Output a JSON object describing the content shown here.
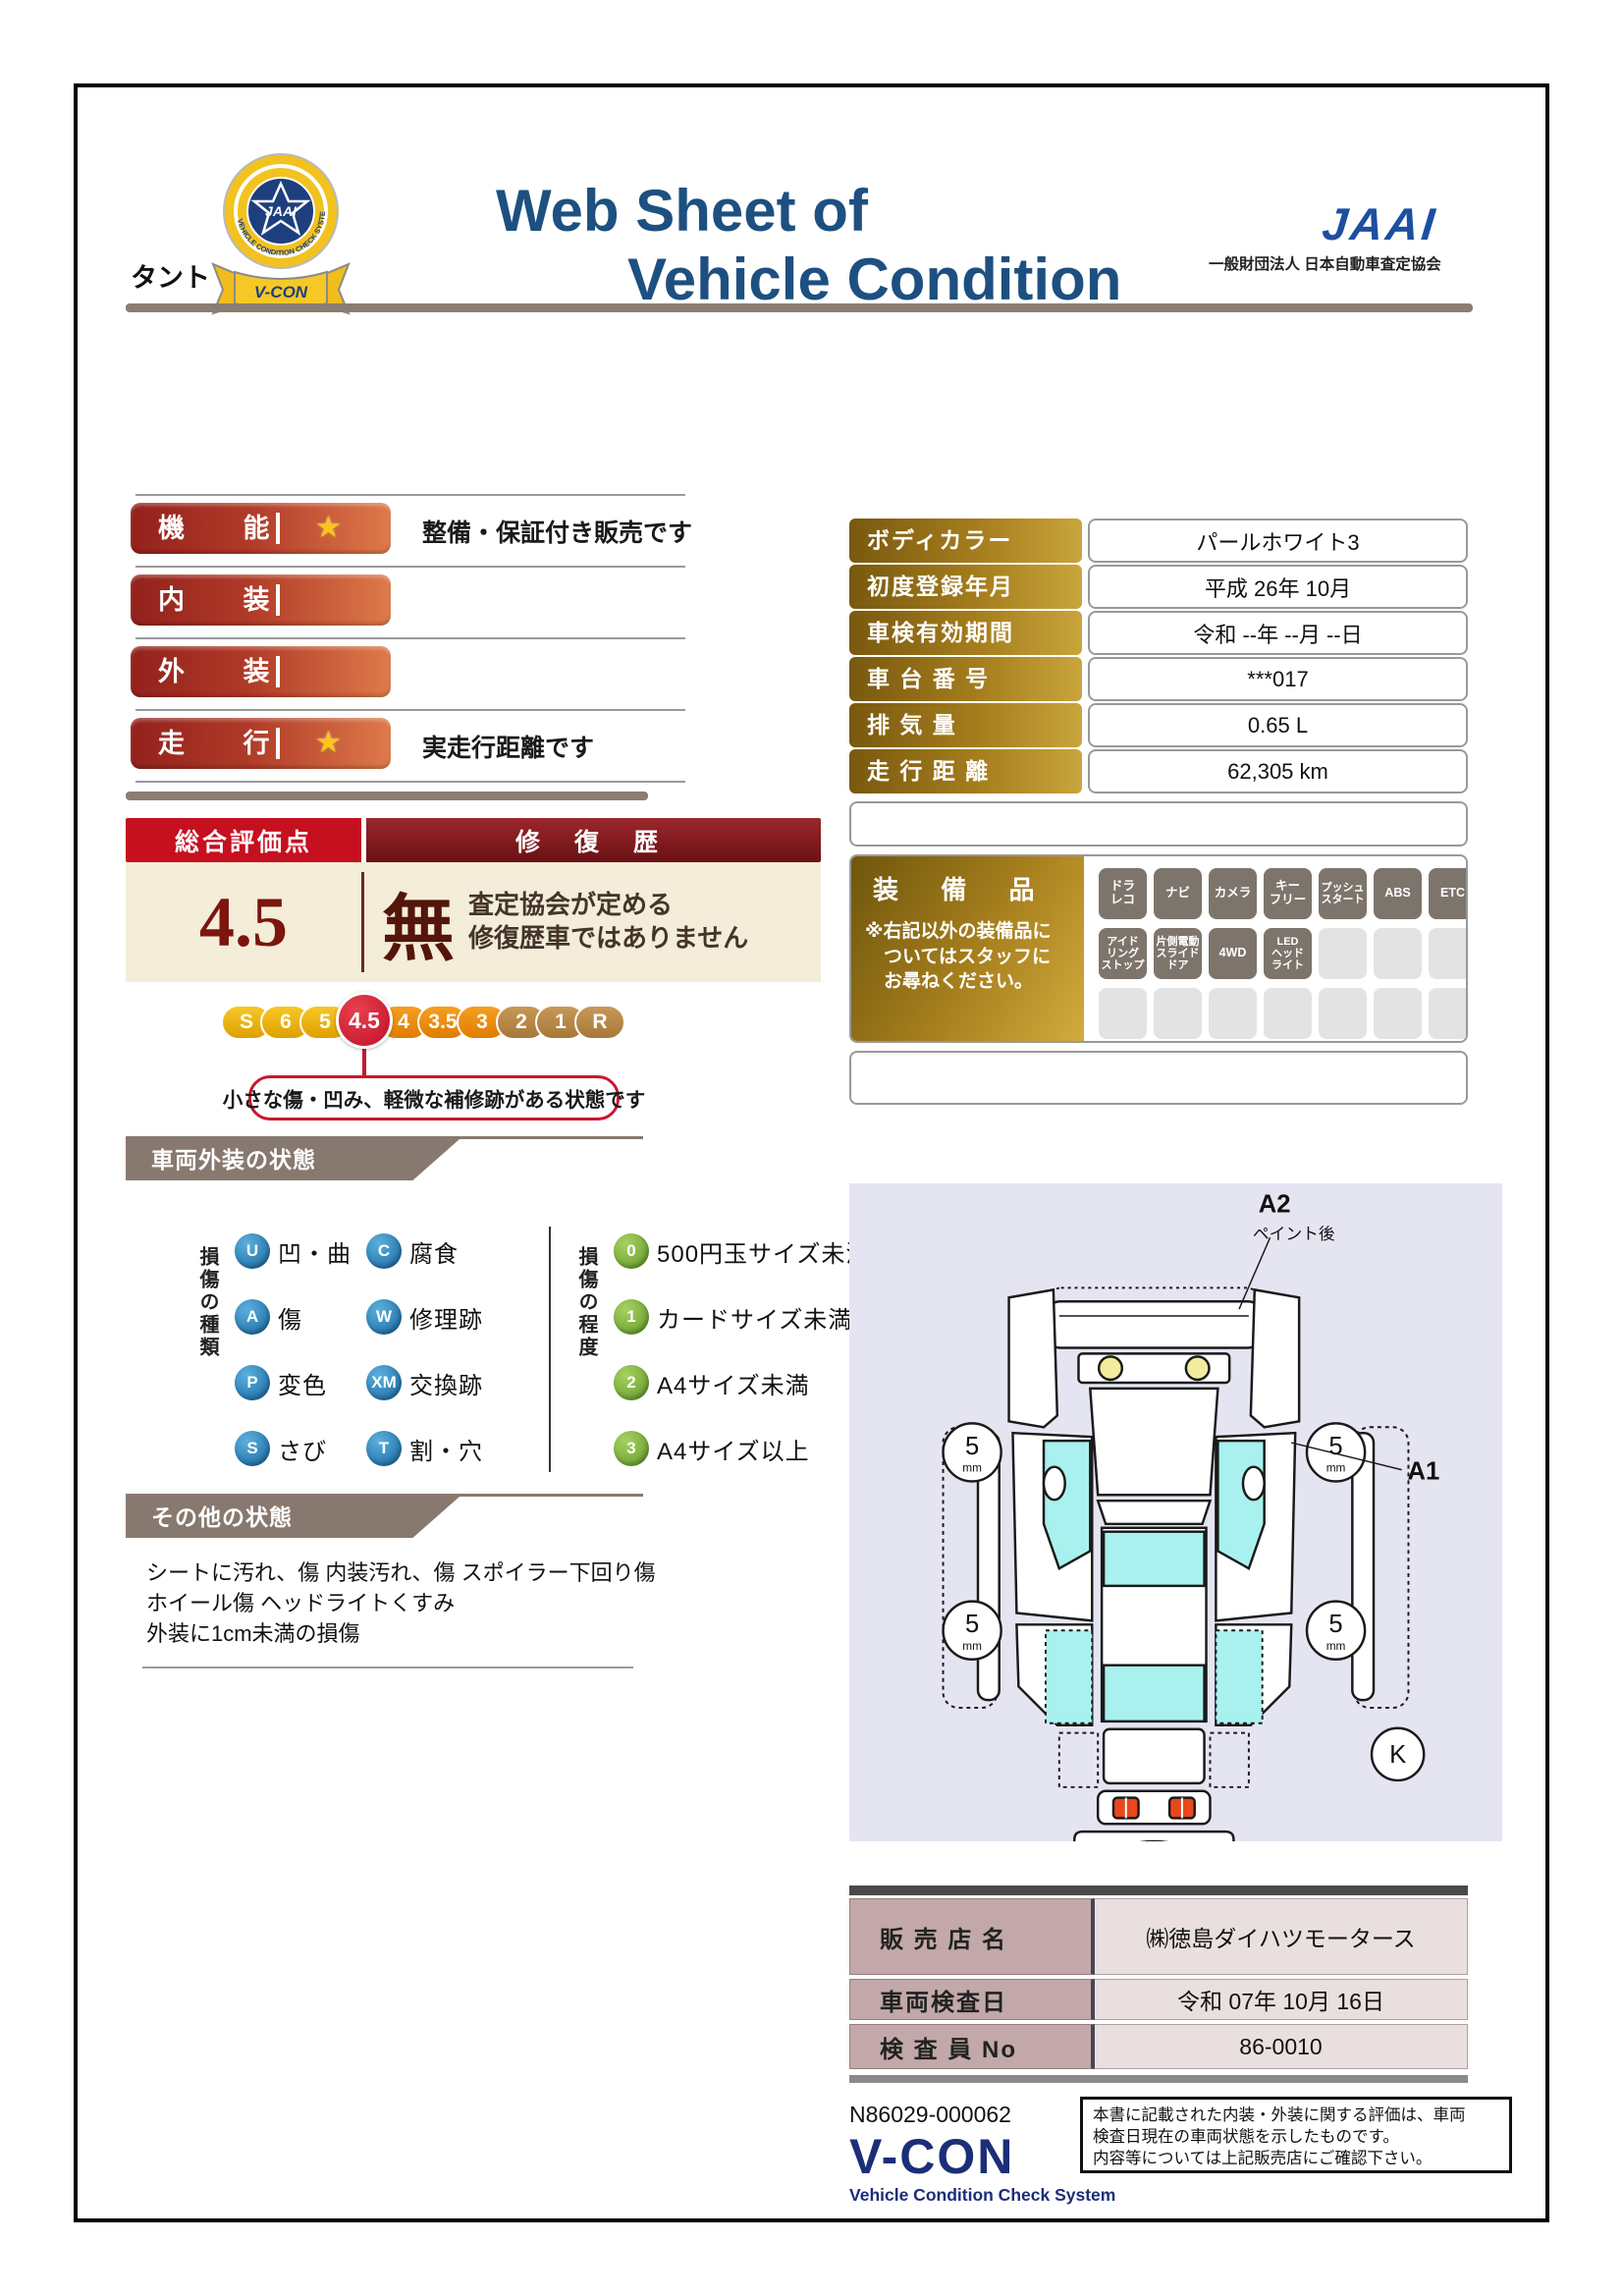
{
  "header": {
    "title_line1": "Web Sheet of",
    "title_line2": "Vehicle Condition",
    "jaai_logo": "JAAI",
    "jaai_org": "一般財団法人 日本自動車査定協会",
    "badge_ribbon": "V-CON",
    "badge_center": "JAAI",
    "badge_ring": "VEHICLE CONDITION CHECK SYSTEM"
  },
  "vehicle_name": "タント",
  "ratings": {
    "rows": [
      {
        "label": "機 能",
        "star": "★",
        "note": "整備・保証付き販売です"
      },
      {
        "label": "内 装",
        "star": "",
        "note": ""
      },
      {
        "label": "外 装",
        "star": "",
        "note": ""
      },
      {
        "label": "走 行",
        "star": "★",
        "note": "実走行距離です"
      }
    ]
  },
  "info": {
    "rows": [
      {
        "label": "ボディカラー",
        "value": "パールホワイト3"
      },
      {
        "label": "初度登録年月",
        "value": "平成 26年 10月"
      },
      {
        "label": "車検有効期間",
        "value": "令和 --年 --月 --日"
      },
      {
        "label": "車 台 番 号",
        "value": "***017"
      },
      {
        "label": "排  気  量",
        "value": "0.65 L"
      },
      {
        "label": "走 行 距 離",
        "value": "62,305 km"
      }
    ]
  },
  "overall": {
    "header_left": "総合評価点",
    "header_right": "修 復 歴",
    "score": "4.5",
    "repair_mark": "無",
    "repair_note": "査定協会が定める\n修復歴車ではありません",
    "scale": [
      "S",
      "6",
      "5",
      "4.5",
      "4",
      "3.5",
      "3",
      "2",
      "1",
      "R"
    ],
    "selected": "4.5",
    "callout": "小さな傷・凹み、軽微な補修跡がある状態です"
  },
  "equipment": {
    "title": "装 備 品",
    "note": "※右記以外の装備品に\n　ついてはスタッフに\n　お尋ねください。",
    "active": [
      "ドラ\nレコ",
      "ナビ",
      "カメラ",
      "キー\nフリー",
      "プッシュ\nスタート",
      "ABS",
      "ETC",
      "アイド\nリング\nストップ",
      "片側電動\nスライド\nドア",
      "4WD",
      "LED\nヘッド\nライト"
    ]
  },
  "exterior": {
    "section_title": "車両外装の状態",
    "kind_label": "損傷の種類",
    "kinds": [
      {
        "code": "U",
        "label": "凹・曲"
      },
      {
        "code": "C",
        "label": "腐食"
      },
      {
        "code": "A",
        "label": "傷"
      },
      {
        "code": "W",
        "label": "修理跡"
      },
      {
        "code": "P",
        "label": "変色"
      },
      {
        "code": "XM",
        "label": "交換跡"
      },
      {
        "code": "S",
        "label": "さび"
      },
      {
        "code": "T",
        "label": "割・穴"
      }
    ],
    "degree_label": "損傷の程度",
    "degrees": [
      {
        "code": "0",
        "label": "500円玉サイズ未満"
      },
      {
        "code": "1",
        "label": "カードサイズ未満"
      },
      {
        "code": "2",
        "label": "A4サイズ未満"
      },
      {
        "code": "3",
        "label": "A4サイズ以上"
      }
    ]
  },
  "other": {
    "section_title": "その他の状態",
    "lines": "シートに汚れ、傷 内装汚れ、傷 スポイラー下回り傷\nホイール傷 ヘッドライトくすみ\n外装に1cm未満の損傷"
  },
  "diagram": {
    "label_a2": "A2",
    "label_a2_note": "ペイント後",
    "label_a1": "A1",
    "label_k": "K",
    "tread_value": "5",
    "tread_unit": "mm"
  },
  "dealer": {
    "rows": [
      {
        "label": "販 売 店 名",
        "value": "㈱徳島ダイハツモータース"
      },
      {
        "label": "車両検査日",
        "value": "令和 07年 10月 16日"
      },
      {
        "label": "検 査 員 No",
        "value": "86-0010"
      }
    ]
  },
  "footer": {
    "serial": "N86029-000062",
    "vcon_logo": "V-CON",
    "vcon_sub": "Vehicle Condition Check System",
    "disclaimer": "本書に記載された内装・外装に関する評価は、車両\n検査日現在の車両状態を示したものです。\n内容等については上記販売店にご確認下さい。"
  },
  "colors": {
    "accent_red": "#c60f1f",
    "bar_gradient_left": "#93211c",
    "bar_gradient_right": "#de7a4a",
    "gold": "#c9a53c",
    "navy": "#1d5080",
    "cream": "#f3edd9",
    "tag_gray": "#87796f",
    "diagram_bg": "#e5e5f2",
    "window_cyan": "#a9f1ee"
  }
}
